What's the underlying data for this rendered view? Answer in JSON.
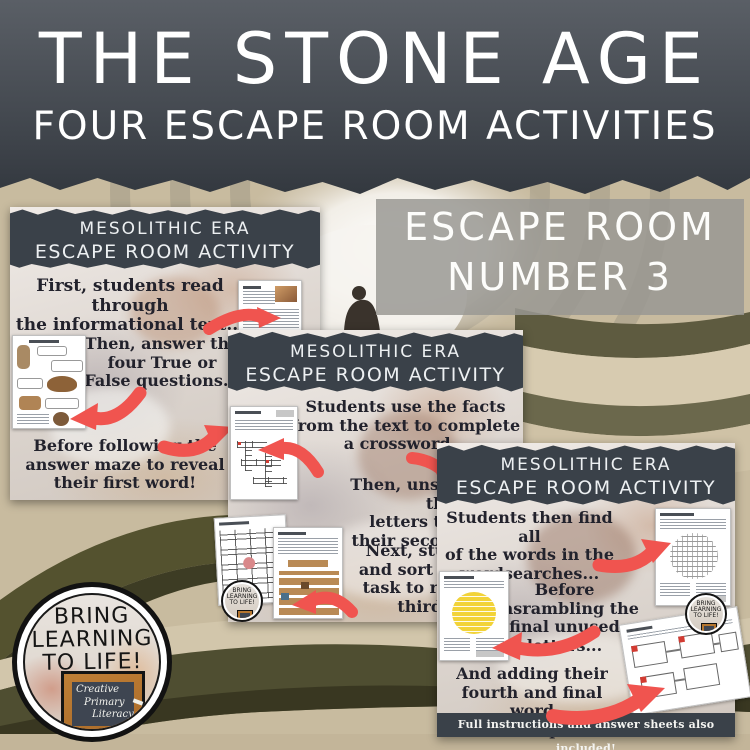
{
  "title": {
    "main": "THE STONE AGE",
    "subtitle": "FOUR ESCAPE ROOM ACTIVITIES"
  },
  "badge": {
    "line1": "ESCAPE ROOM",
    "line2": "NUMBER 3"
  },
  "cards": [
    {
      "header": {
        "line1": "MESOLITHIC ERA",
        "line2": "ESCAPE ROOM ACTIVITY"
      },
      "steps": [
        {
          "lines": [
            "First, students read through",
            "the informational text..."
          ]
        },
        {
          "lines": [
            "Then, answer the",
            "four True or",
            "False questions..."
          ]
        },
        {
          "lines": [
            "Before following the",
            "answer maze to reveal",
            "their first word!"
          ]
        }
      ]
    },
    {
      "header": {
        "line1": "MESOLITHIC ERA",
        "line2": "ESCAPE ROOM ACTIVITY"
      },
      "steps": [
        {
          "lines": [
            "Students use the facts",
            "from the text to complete",
            "a crossword..."
          ]
        },
        {
          "lines": [
            "Then, unscrambling the",
            "letters to reveal",
            "their second word..."
          ]
        },
        {
          "lines": [
            "Next, students cut",
            "and sort the images",
            "task to reveal their",
            "third word!"
          ]
        }
      ]
    },
    {
      "header": {
        "line1": "MESOLITHIC ERA",
        "line2": "ESCAPE ROOM ACTIVITY"
      },
      "steps": [
        {
          "lines": [
            "Students then find all",
            "of the words in the",
            "wordsearches..."
          ]
        },
        {
          "lines": [
            "Before",
            "unsrambling the",
            "final unused",
            "letters..."
          ]
        },
        {
          "lines": [
            "And adding their",
            "fourth and final word",
            "to escape!"
          ]
        }
      ],
      "footer": "Full instructions and answer sheets also included!"
    }
  ],
  "logo": {
    "line1": "BRING",
    "line2": "LEARNING",
    "line3": "TO LIFE!",
    "board_line1": "Creative",
    "board_line2": "Primary",
    "board_line3": "Literacy"
  },
  "icons": {
    "red_arrow": "curved-red-arrow",
    "person": "person-silhouette-in-maze"
  },
  "colors": {
    "accent_red": "#f0544f",
    "slate_dark": "#3a4149",
    "maze_tan": "#c8bb9f",
    "hedge_dark": "#4f4e31",
    "badge_gray": "#989793",
    "highlight_yellow": "#f2d338"
  }
}
